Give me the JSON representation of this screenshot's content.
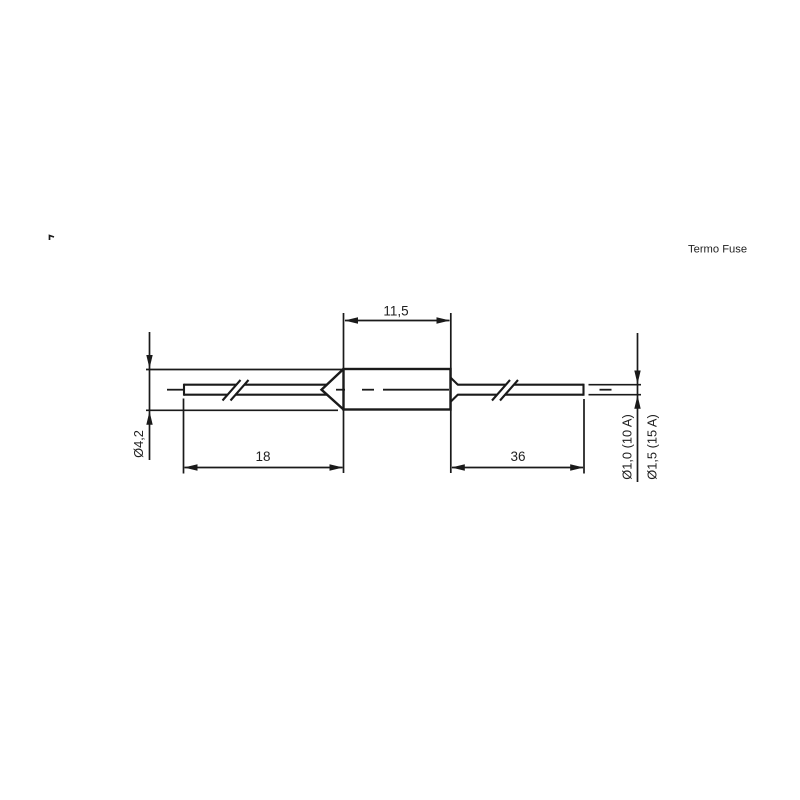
{
  "title": "Termo Fuse",
  "colors": {
    "ink": "#1a1a1a",
    "background": "#ffffff"
  },
  "drawing": {
    "component": "axial thermal fuse",
    "dimensions": {
      "body_length": "11,5",
      "left_lead_length": "18",
      "right_lead_length": "36",
      "body_diameter": "Ø4,2",
      "lead_diameter_small": "Ø1,0 (10 A)",
      "lead_diameter_large": "Ø1,5 (15 A)"
    }
  }
}
